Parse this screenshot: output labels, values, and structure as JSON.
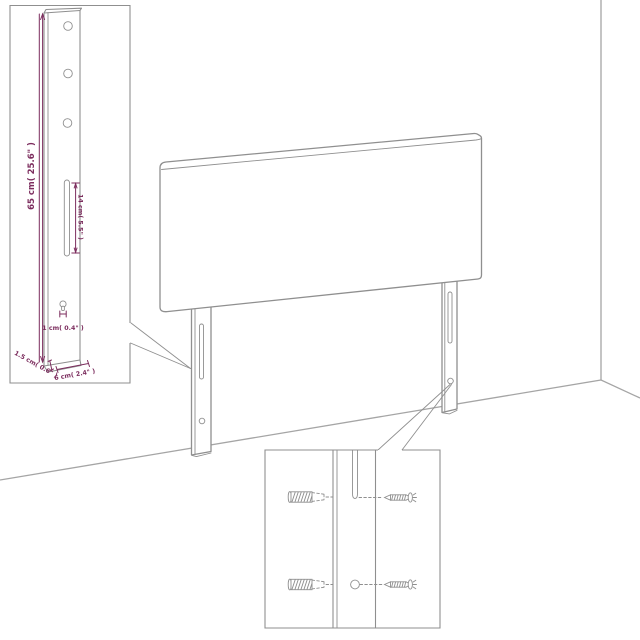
{
  "colors": {
    "background": "#ffffff",
    "line": "#8f8f8f",
    "room_line": "#a5a5a5",
    "dimension": "#7c2d5e"
  },
  "labels": {
    "height": "65 cm( 25.6\" )",
    "slot": "14 cm( 5.5\" )",
    "hole": "1 cm( 0.4\" )",
    "thickness": "1.5 cm( 0.6\" )",
    "depth": "6 cm( 2.4\" )"
  },
  "figures": {
    "main": "headboard-with-two-mounting-legs",
    "inset_top_left": "leg-dimension-detail",
    "inset_bottom": "wall-plug-and-screw-mounting-detail"
  }
}
